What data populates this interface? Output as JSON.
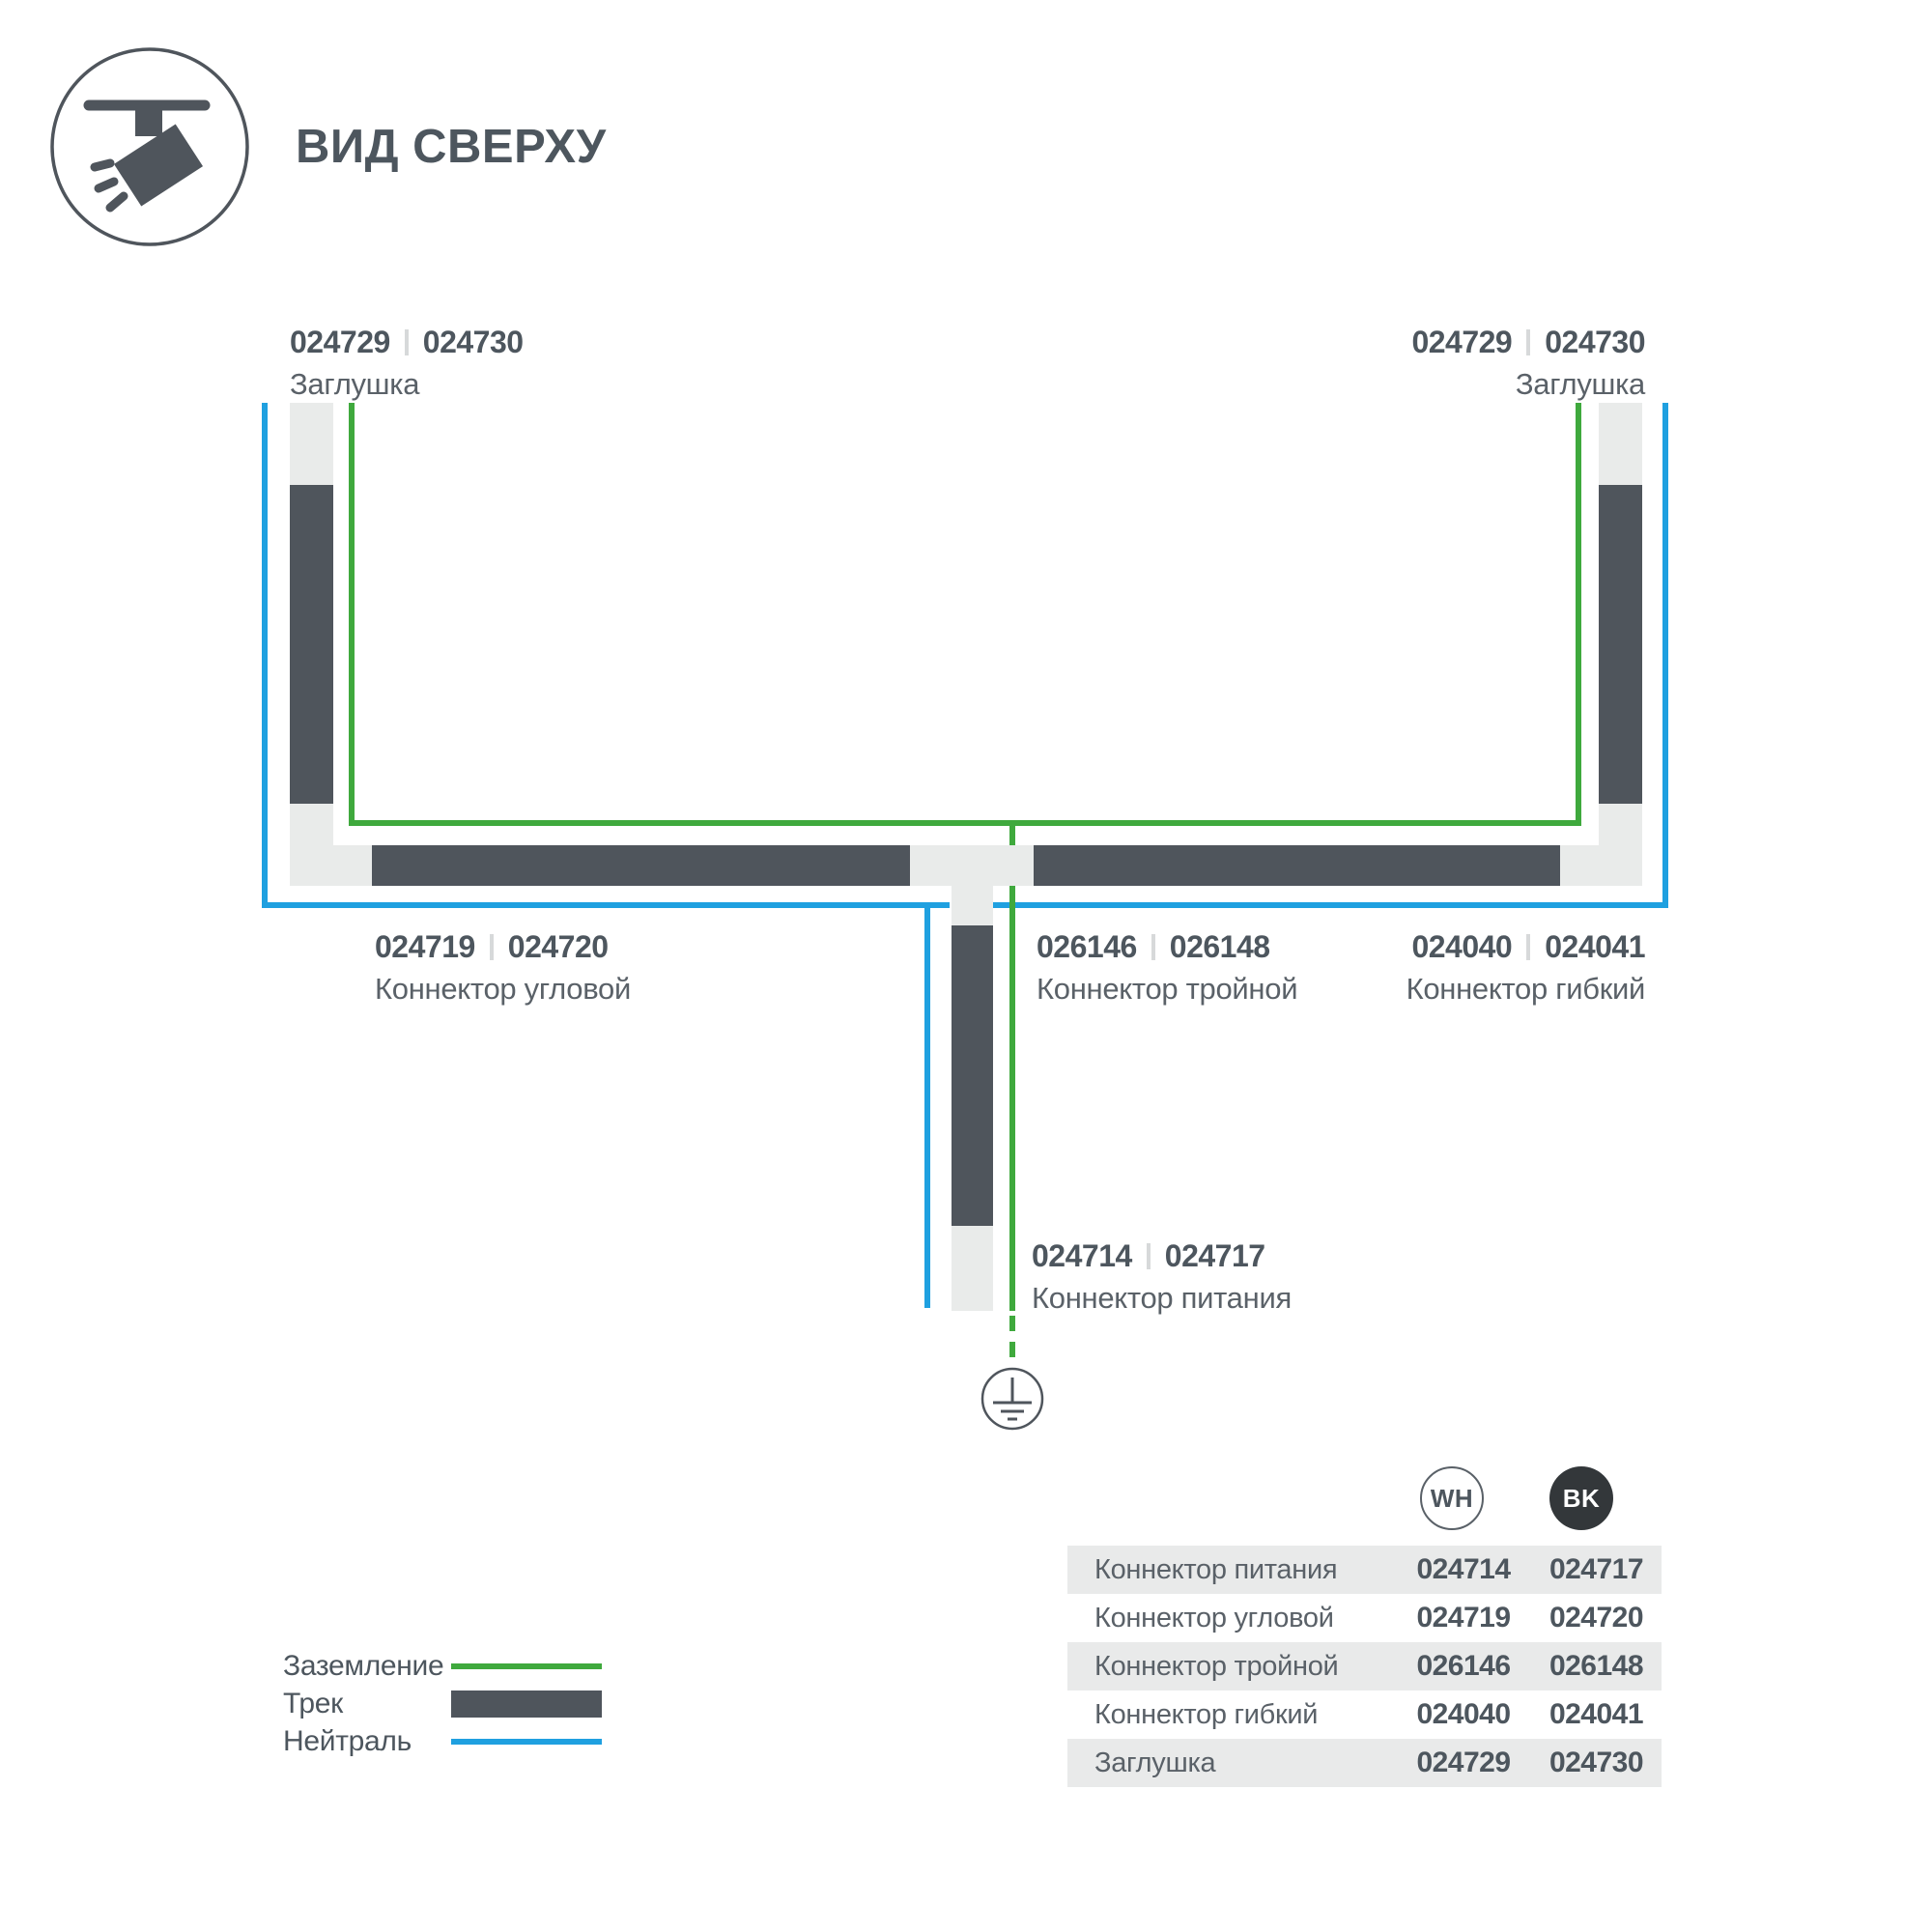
{
  "page": {
    "title": "ВИД СВЕРХУ"
  },
  "colors": {
    "track": "#4F555C",
    "ground_green": "#3FA93D",
    "neutral_blue": "#1FA0E0",
    "connector_gray": "#E9EBEA",
    "table_row_gray": "#E9EAEA",
    "text_dark": "#4D565E",
    "text_gray": "#5A6168"
  },
  "labels": {
    "endcap_top_left": {
      "code_wh": "024729",
      "code_bk": "024730",
      "name": "Заглушка"
    },
    "endcap_top_right": {
      "code_wh": "024729",
      "code_bk": "024730",
      "name": "Заглушка"
    },
    "corner": {
      "code_wh": "024719",
      "code_bk": "024720",
      "name": "Коннектор угловой"
    },
    "triple": {
      "code_wh": "026146",
      "code_bk": "026148",
      "name": "Коннектор тройной"
    },
    "flexible": {
      "code_wh": "024040",
      "code_bk": "024041",
      "name": "Коннектор гибкий"
    },
    "power": {
      "code_wh": "024714",
      "code_bk": "024717",
      "name": "Коннектор питания"
    }
  },
  "legend": {
    "items": [
      {
        "label": "Заземление"
      },
      {
        "label": "Трек"
      },
      {
        "label": "Нейтраль"
      }
    ]
  },
  "table": {
    "col_wh": "WH",
    "col_bk": "BK",
    "rows": [
      {
        "name": "Коннектор питания",
        "wh": "024714",
        "bk": "024717"
      },
      {
        "name": "Коннектор угловой",
        "wh": "024719",
        "bk": "024720"
      },
      {
        "name": "Коннектор тройной",
        "wh": "026146",
        "bk": "026148"
      },
      {
        "name": "Коннектор гибкий",
        "wh": "024040",
        "bk": "024041"
      },
      {
        "name": "Заглушка",
        "wh": "024729",
        "bk": "024730"
      }
    ]
  }
}
